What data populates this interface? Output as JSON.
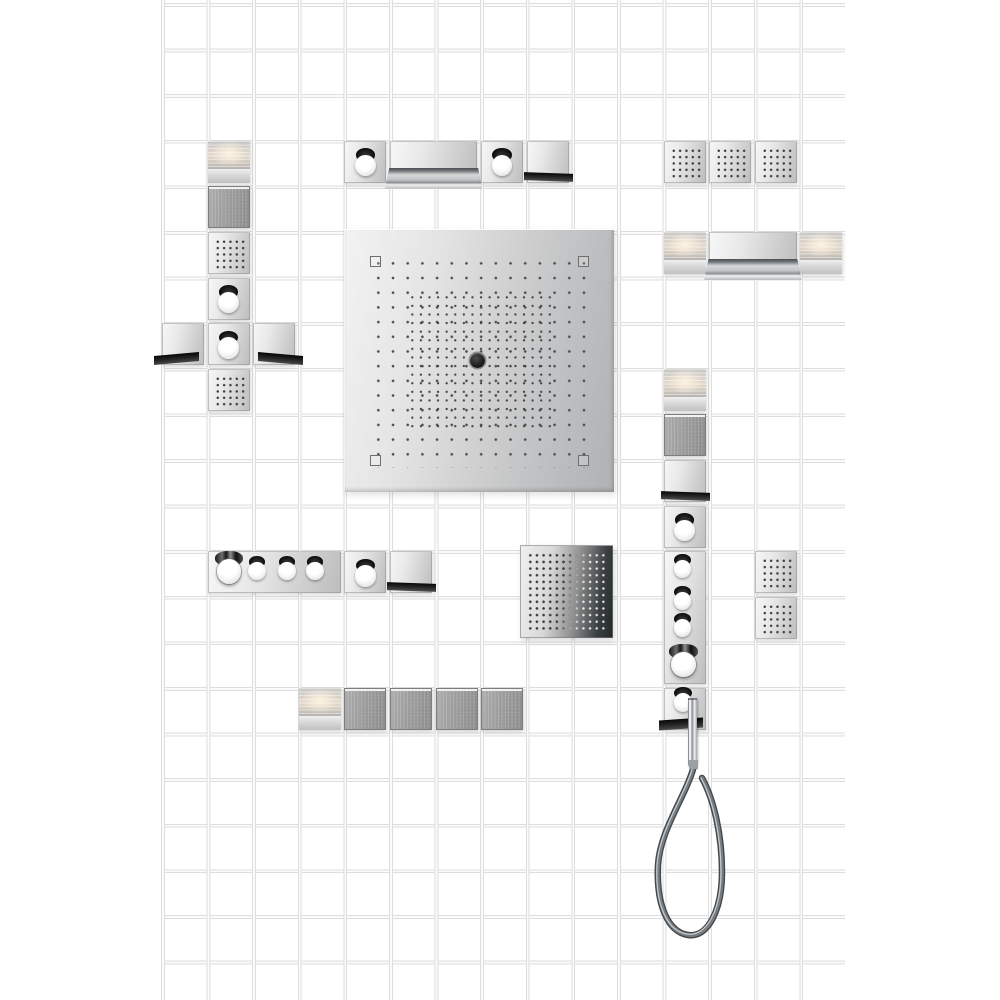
{
  "scene": {
    "type": "product-collage",
    "subject": "modular-shower-system-on-white-tile-wall",
    "tile_grid": {
      "columns": 15,
      "rows": 22,
      "pitch_px": 45.6,
      "tile_color": "#ffffff",
      "joint_color": "#dedede"
    },
    "palette": {
      "chrome_light": "#f5f5f5",
      "chrome_mid": "#d4d4d4",
      "chrome_dark": "#b9b9b9",
      "black_trim": "#141414",
      "warm_light_glow": "#f6e9d8",
      "glass_gray": "#9a9a9a",
      "nozzle_dot": "#4e4e4e",
      "hose_gray": "#42484c"
    },
    "module_types": {
      "light": "backlit light module",
      "texture": "structured glass module",
      "spray6": "body spray module with 6x6 nozzle grid",
      "knob": "shut-off valve module with round handle",
      "spout-small": "spout module with black lip",
      "spout-left": "spout module, lip projecting left",
      "spout-right": "spout module, lip projecting right",
      "spout-wide": "double-width waterfall spout module",
      "thermo-h": "horizontal thermostat module with four handles",
      "thermo-v": "vertical thermostat module with four controls",
      "bighead": "large overhead shower plate with nozzle field and center outlet",
      "spray12": "large body spray plate with 12x12 nozzle grid",
      "handshower": "holder module with baton hand shower and hose"
    },
    "modules": [
      {
        "type": "light",
        "x": 207.5,
        "y": 140.8
      },
      {
        "type": "texture",
        "x": 207.5,
        "y": 186.4
      },
      {
        "type": "spray6",
        "x": 207.5,
        "y": 232
      },
      {
        "type": "knob",
        "x": 207.5,
        "y": 277.6
      },
      {
        "type": "spout-left",
        "x": 161.9,
        "y": 323.2
      },
      {
        "type": "knob",
        "x": 207.5,
        "y": 323.2
      },
      {
        "type": "spout-right",
        "x": 253.1,
        "y": 323.2
      },
      {
        "type": "spray6",
        "x": 207.5,
        "y": 368.8
      },
      {
        "type": "knob",
        "x": 344.3,
        "y": 140.8
      },
      {
        "type": "spout-wide",
        "x": 389.9,
        "y": 140.8,
        "w": 87.6
      },
      {
        "type": "knob",
        "x": 481.1,
        "y": 140.8
      },
      {
        "type": "spout-small",
        "x": 526.7,
        "y": 140.8
      },
      {
        "type": "spray6",
        "x": 663.5,
        "y": 140.8
      },
      {
        "type": "spray6",
        "x": 709.1,
        "y": 140.8
      },
      {
        "type": "spray6",
        "x": 754.7,
        "y": 140.8
      },
      {
        "type": "light",
        "x": 663.5,
        "y": 232
      },
      {
        "type": "spout-wide",
        "x": 709.1,
        "y": 232,
        "w": 87.6
      },
      {
        "type": "light",
        "x": 800.3,
        "y": 232
      },
      {
        "type": "bighead",
        "x": 344,
        "y": 229,
        "w": 270,
        "h": 263
      },
      {
        "type": "light",
        "x": 663.5,
        "y": 368.8
      },
      {
        "type": "texture",
        "x": 663.5,
        "y": 414.4
      },
      {
        "type": "spout-small",
        "x": 663.5,
        "y": 460
      },
      {
        "type": "knob",
        "x": 663.5,
        "y": 505.6
      },
      {
        "type": "thermo-v",
        "x": 663.5,
        "y": 551.2,
        "h": 133
      },
      {
        "type": "handshower",
        "x": 663.5,
        "y": 688
      },
      {
        "type": "thermo-h",
        "x": 207.5,
        "y": 551.2,
        "w": 133
      },
      {
        "type": "knob",
        "x": 344.3,
        "y": 551.2
      },
      {
        "type": "spout-small",
        "x": 389.9,
        "y": 551.2
      },
      {
        "type": "spray12",
        "x": 520,
        "y": 545,
        "w": 93,
        "h": 93
      },
      {
        "type": "spray6",
        "x": 754.7,
        "y": 551.2
      },
      {
        "type": "spray6",
        "x": 754.7,
        "y": 596.8
      },
      {
        "type": "light",
        "x": 298.7,
        "y": 688
      },
      {
        "type": "texture",
        "x": 344.3,
        "y": 688
      },
      {
        "type": "texture",
        "x": 389.9,
        "y": 688
      },
      {
        "type": "texture",
        "x": 435.5,
        "y": 688
      },
      {
        "type": "texture",
        "x": 481.1,
        "y": 688
      }
    ],
    "hose": {
      "color": "#42484c",
      "loop_left_x": 658,
      "loop_right_x": 722,
      "loop_bottom_y": 937
    }
  }
}
